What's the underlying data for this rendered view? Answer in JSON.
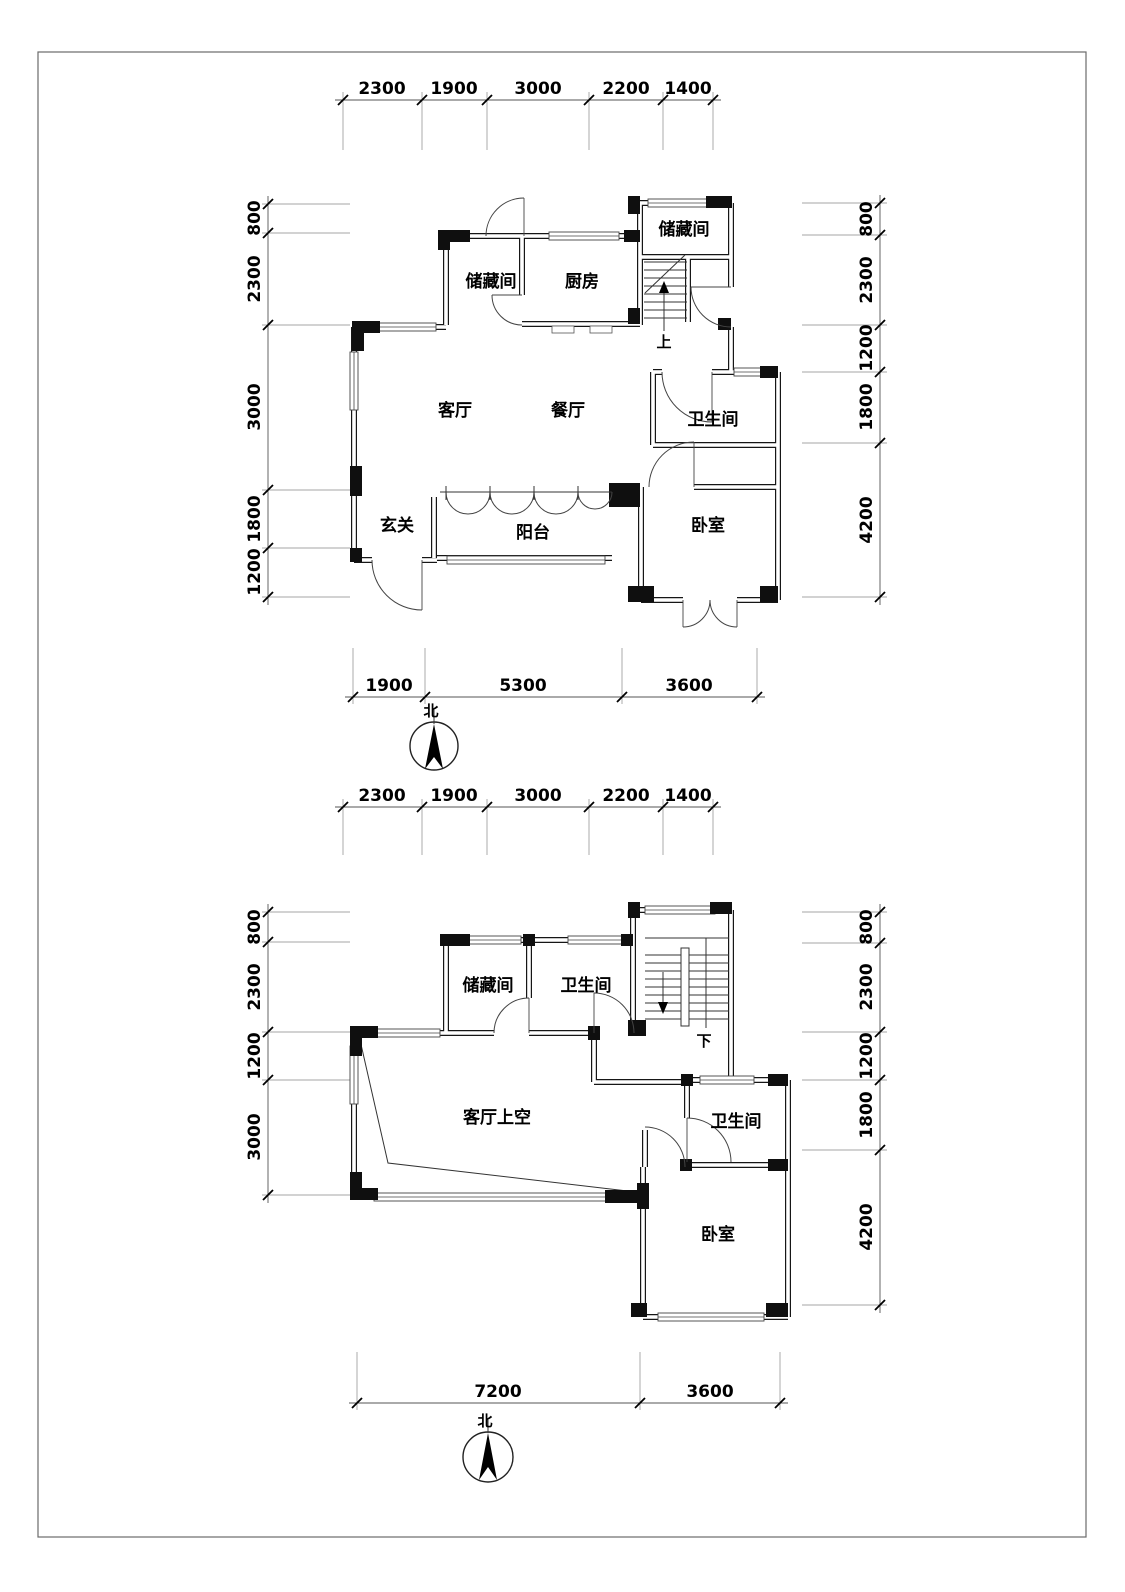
{
  "drawing": {
    "type": "residential floor plans, two levels",
    "frame_color": "#6a6a6a"
  },
  "floor1": {
    "rooms": {
      "storage_nw": "储藏间",
      "kitchen": "厨房",
      "storage_ne": "储藏间",
      "stair_dir": "上",
      "living": "客厅",
      "dining": "餐厅",
      "bath": "卫生间",
      "foyer": "玄关",
      "balcony": "阳台",
      "bedroom": "卧室"
    },
    "dims_top": [
      "2300",
      "1900",
      "3000",
      "2200",
      "1400"
    ],
    "dims_left": [
      "800",
      "2300",
      "3000",
      "1800",
      "1200"
    ],
    "dims_right": [
      "800",
      "2300",
      "1200",
      "1800",
      "4200"
    ],
    "dims_bottom": [
      "1900",
      "5300",
      "3600"
    ],
    "north_label": "北"
  },
  "floor2": {
    "rooms": {
      "storage": "储藏间",
      "bath_top": "卫生间",
      "stair_dir": "下",
      "living_void": "客厅上空",
      "bath_right": "卫生间",
      "bedroom": "卧室"
    },
    "dims_top": [
      "2300",
      "1900",
      "3000",
      "2200",
      "1400"
    ],
    "dims_left": [
      "800",
      "2300",
      "1200",
      "3000"
    ],
    "dims_right": [
      "800",
      "2300",
      "1200",
      "1800",
      "4200"
    ],
    "dims_bottom": [
      "7200",
      "3600"
    ],
    "north_label": "北"
  }
}
